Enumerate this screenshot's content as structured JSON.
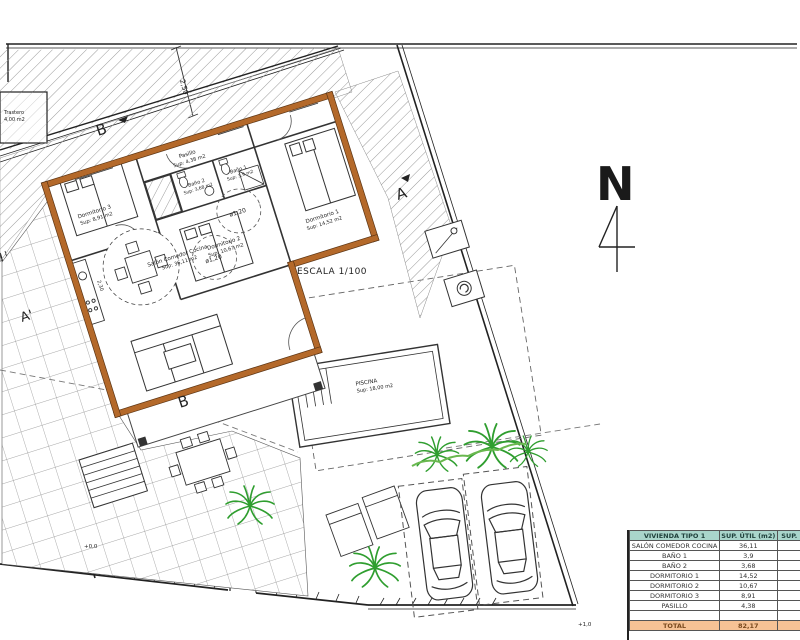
{
  "plan": {
    "scale": "ESCALA 1/100",
    "north": "N",
    "sections": {
      "a": "A",
      "a_prime": "A'",
      "b_top": "B",
      "b_bottom": "B"
    },
    "levels": {
      "gate": "+0,0",
      "corner": "+1,0"
    },
    "dims": {
      "setback": "2,50",
      "circle1": "ø1,20",
      "circle2": "ø1,20",
      "counter": "2,30"
    },
    "rooms": {
      "salon": {
        "name": "Salón Comedor Cocina",
        "sup": "Sup: 36,11 m2"
      },
      "dorm1": {
        "name": "Dormitorio 1",
        "sup": "Sup: 14,52 m2"
      },
      "dorm2": {
        "name": "Dormitorio 2",
        "sup": "Sup: 10,67 m2"
      },
      "dorm3": {
        "name": "Dormitorio 3",
        "sup": "Sup: 8,91 m2"
      },
      "bano1": {
        "name": "Baño 1",
        "sup": "Sup: 3,9 m2"
      },
      "bano2": {
        "name": "Baño 2",
        "sup": "Sup: 3,68 m2"
      },
      "pasillo": {
        "name": "Pasillo",
        "sup": "Sup: 4,38 m2"
      },
      "piscina": {
        "name": "PISCINA",
        "sup": "Sup: 18,00 m2"
      },
      "trastero": {
        "name": "Trastero",
        "sup": "4,00 m2"
      }
    }
  },
  "colors": {
    "wall": "#b4692a",
    "wall_edge": "#5a3414",
    "palm": "#2f9e2f",
    "hedge": "#6ab84f",
    "line": "#222222"
  },
  "table": {
    "header": [
      "VIVIENDA TIPO 1",
      "SUP. ÚTIL (m2)",
      "SUP."
    ],
    "rows": [
      [
        "SALÓN COMEDOR COCINA",
        "36,11"
      ],
      [
        "BAÑO 1",
        "3,9"
      ],
      [
        "BAÑO 2",
        "3,68"
      ],
      [
        "DORMITORIO 1",
        "14,52"
      ],
      [
        "DORMITORIO 2",
        "10,67"
      ],
      [
        "DORMITORIO 3",
        "8,91"
      ],
      [
        "PASILLO",
        "4,38"
      ],
      [
        "",
        ""
      ]
    ],
    "total_label": "TOTAL",
    "total_value": "82,17",
    "colors": {
      "header_bg": "#a9d5cb",
      "total_bg": "#f6c295"
    }
  }
}
